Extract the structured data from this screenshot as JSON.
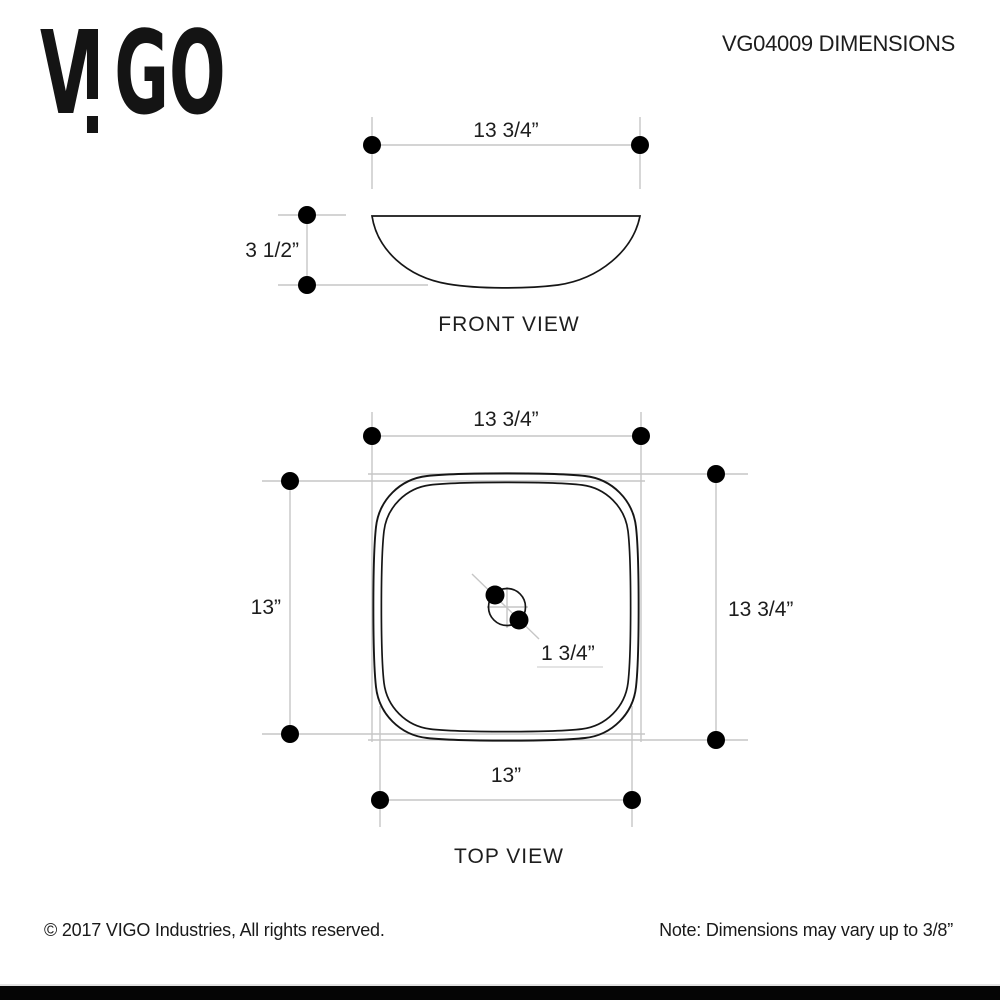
{
  "logo": {
    "brand": "VIGO",
    "letter_v": "V",
    "letters_go": "GO"
  },
  "header": {
    "title": "VG04009 DIMENSIONS"
  },
  "front_view": {
    "caption": "FRONT VIEW",
    "width_dim": "13 3/4”",
    "height_dim": "3 1/2”"
  },
  "top_view": {
    "caption": "TOP VIEW",
    "top_dim": "13 3/4”",
    "left_dim": "13”",
    "right_dim": "13 3/4”",
    "bottom_dim": "13”",
    "drain_dim": "1 3/4”"
  },
  "footer": {
    "copyright": "© 2017 VIGO Industries, All rights reserved.",
    "note": "Note: Dimensions may vary up to 3/8”"
  },
  "colors": {
    "ink": "#161616",
    "dimension_line": "#c6c6c6",
    "dot": "#000000",
    "footer_bar": "#050505"
  }
}
